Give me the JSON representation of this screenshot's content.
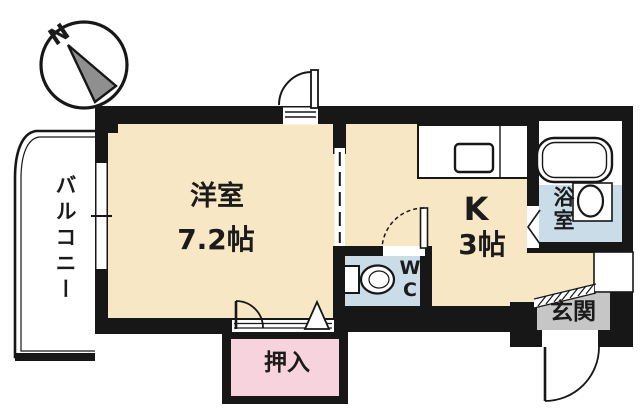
{
  "compass": {
    "north_label": "N"
  },
  "rooms": {
    "balcony": {
      "label": "バルコニー"
    },
    "western_room": {
      "name": "洋室",
      "size": "7.2帖"
    },
    "kitchen": {
      "name": "K",
      "size": "3帖"
    },
    "wc": {
      "label": "WC"
    },
    "bathroom": {
      "label": "浴室"
    },
    "entrance": {
      "label": "玄関"
    },
    "closet": {
      "label": "押入"
    }
  },
  "colors": {
    "wall": "#171717",
    "room_fill": "#f7e7c4",
    "wet_area_fill": "#c9dce8",
    "closet_fill": "#f6d3dd",
    "entrance_fill": "#c6c6c6",
    "compass_needle": "#8f8f8f",
    "line": "#171717"
  }
}
